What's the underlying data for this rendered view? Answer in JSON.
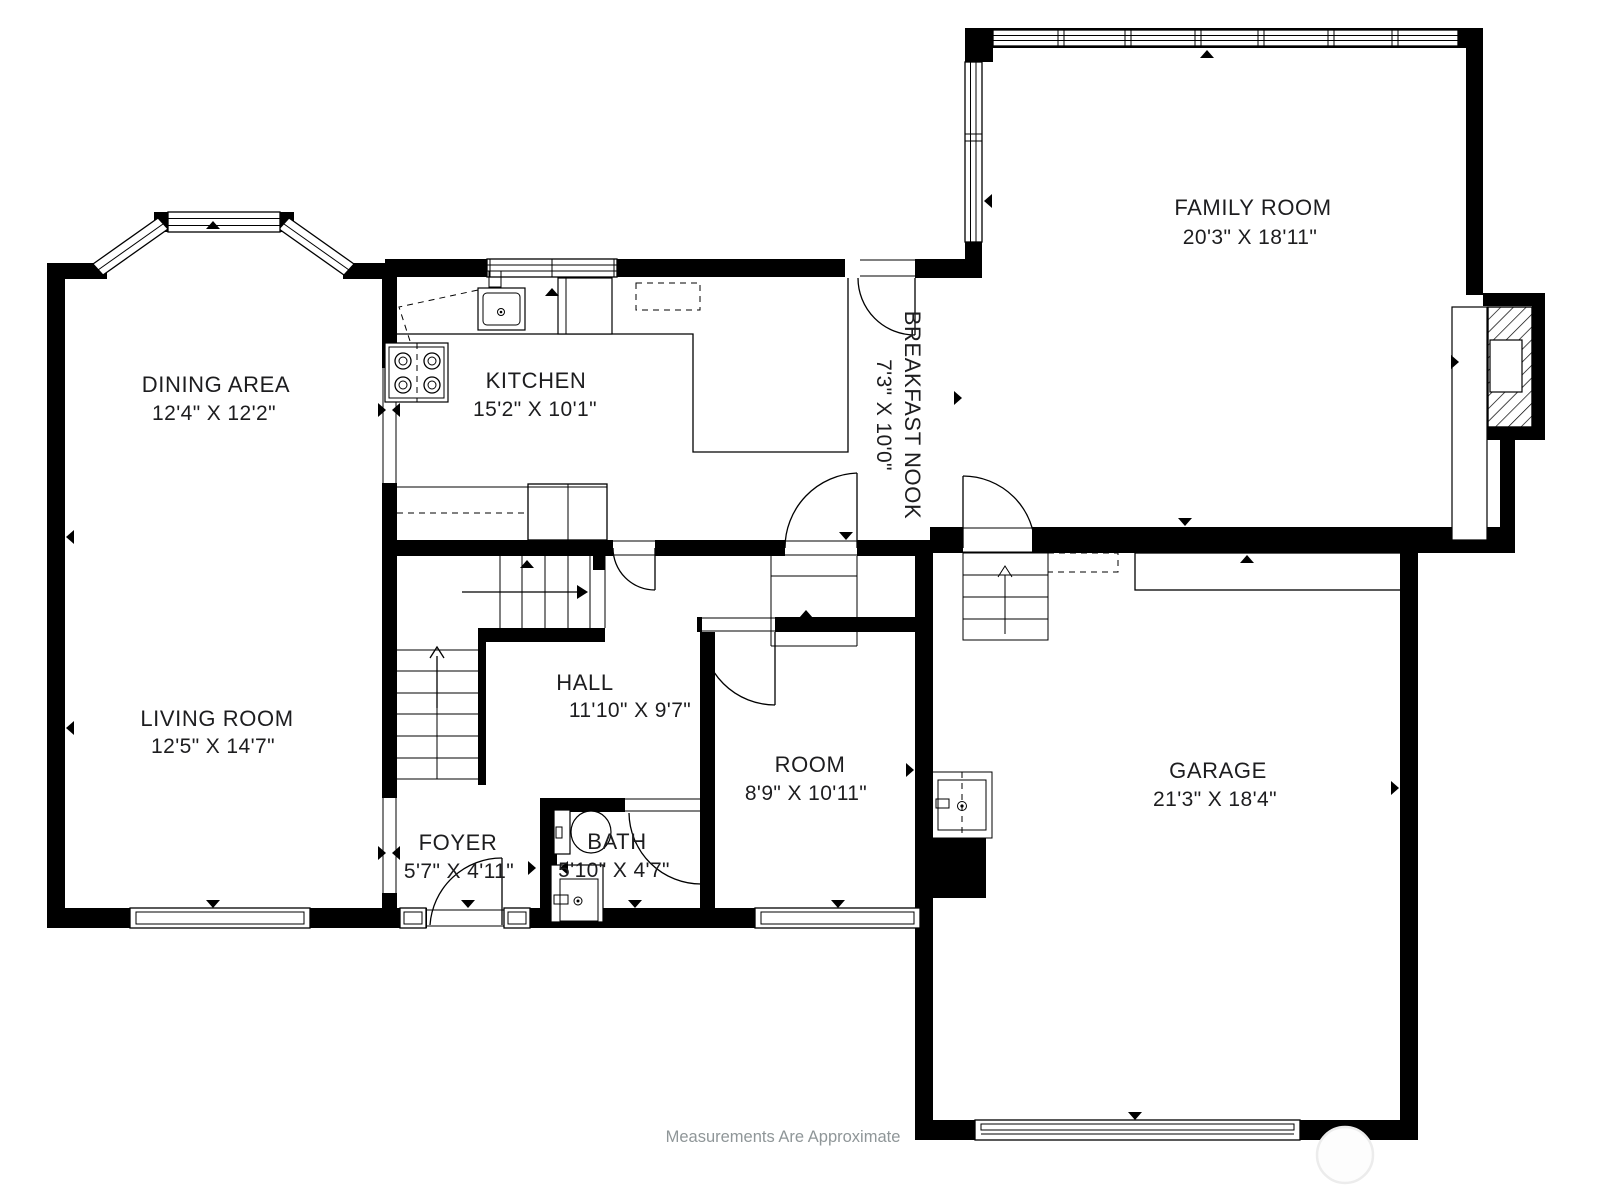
{
  "plan": {
    "type": "residential-floor-plan",
    "floor": "main level",
    "wall_color": "#000000",
    "background": "#ffffff",
    "text_color": "#1d1d1f",
    "muted_text_color": "#8f9698"
  },
  "rooms": {
    "family_room": {
      "name": "FAMILY ROOM",
      "dims": "20'3\" X 18'11\""
    },
    "dining_area": {
      "name": "DINING AREA",
      "dims": "12'4\" X 12'2\""
    },
    "kitchen": {
      "name": "KITCHEN",
      "dims": "15'2\" X 10'1\""
    },
    "breakfast_nook": {
      "name": "BREAKFAST NOOK",
      "dims": "7'3\" X 10'0\""
    },
    "living_room": {
      "name": "LIVING ROOM",
      "dims": "12'5\" X 14'7\""
    },
    "hall": {
      "name": "HALL",
      "dims": "11'10\" X 9'7\""
    },
    "foyer": {
      "name": "FOYER",
      "dims": "5'7\" X 4'11\""
    },
    "bath": {
      "name": "BATH",
      "dims": "5'10\" X 4'7\""
    },
    "room": {
      "name": "ROOM",
      "dims": "8'9\" X 10'11\""
    },
    "garage": {
      "name": "GARAGE",
      "dims": "21'3\" X 18'4\""
    }
  },
  "footer": {
    "disclaimer": "Measurements Are Approximate"
  }
}
